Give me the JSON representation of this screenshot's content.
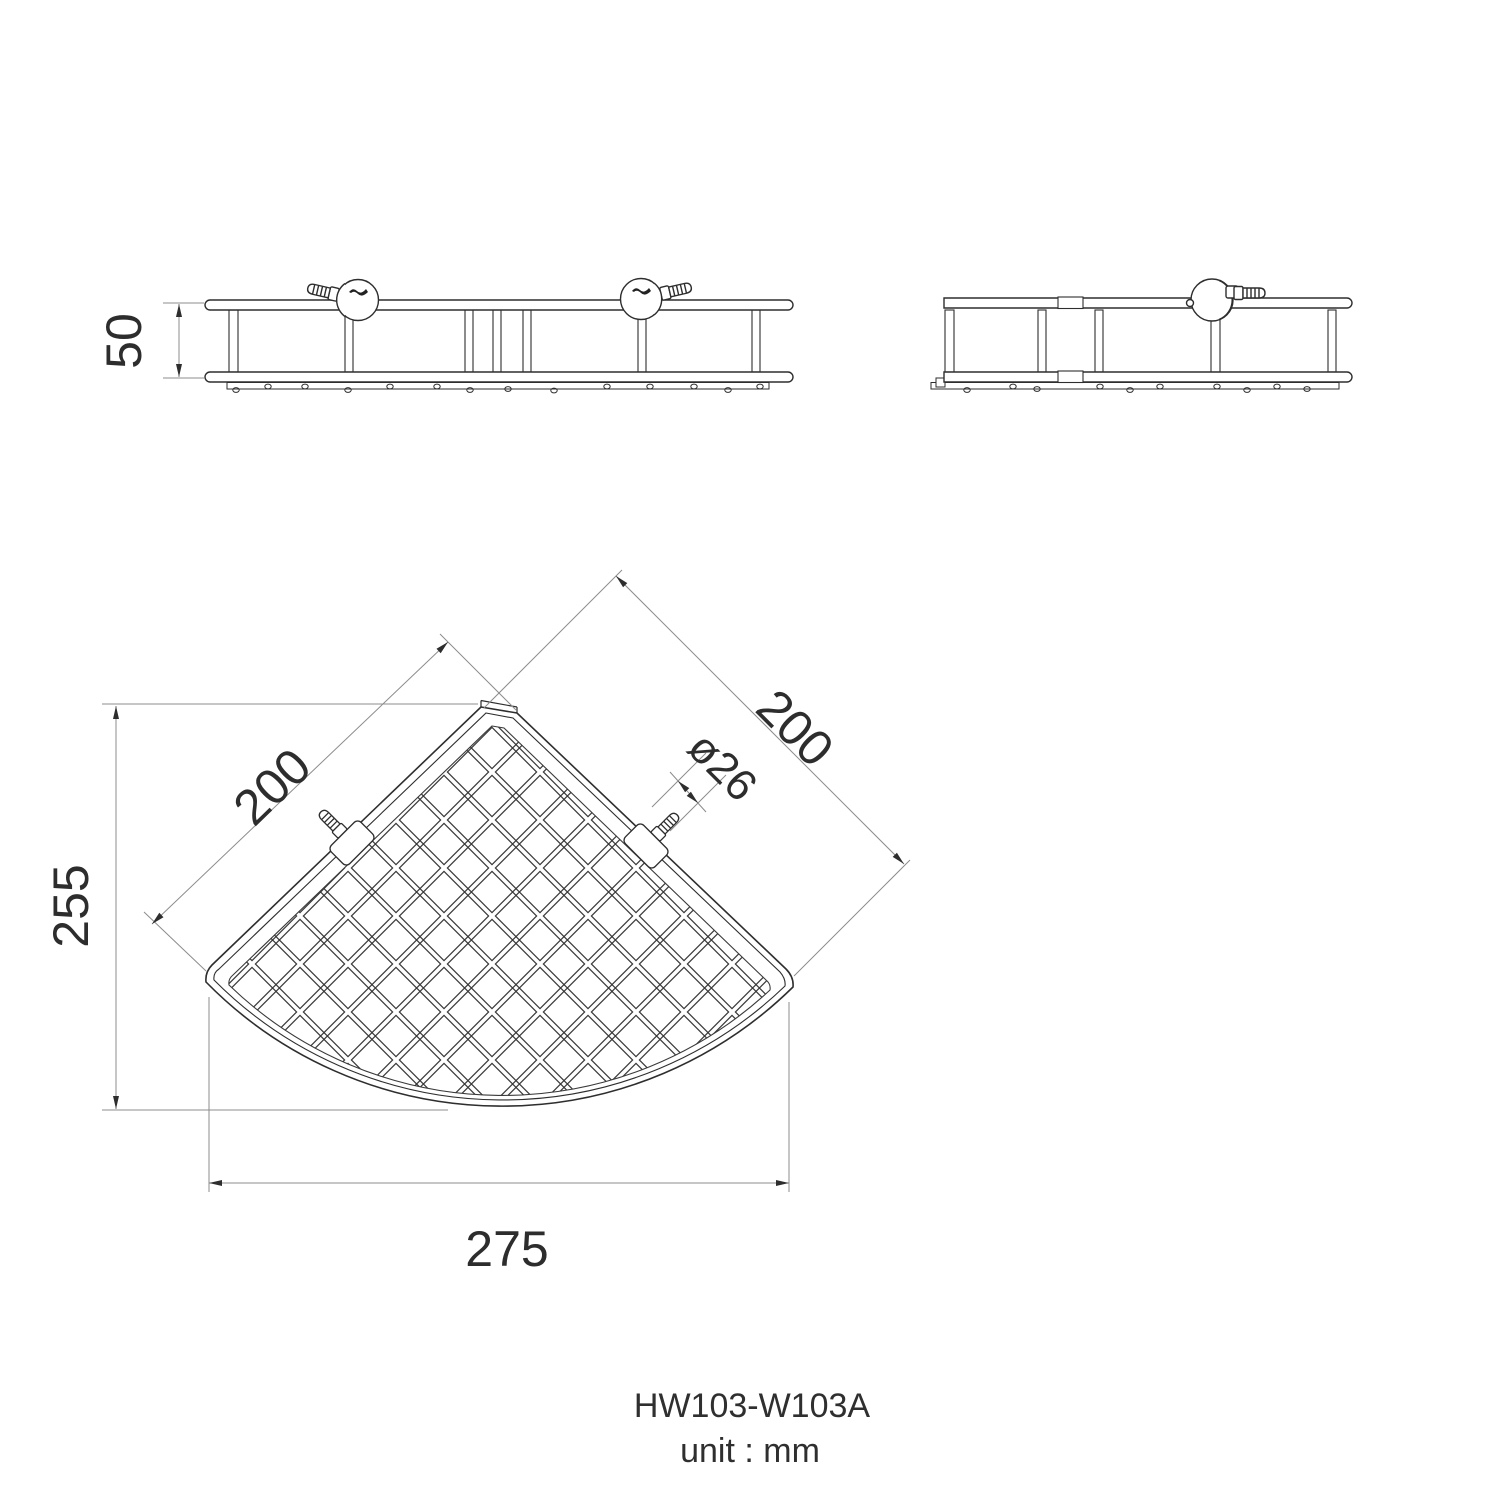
{
  "drawing": {
    "product_code": "HW103-W103A",
    "unit_note": "unit : mm",
    "views": {
      "front": {
        "height_dim": "50"
      },
      "plan": {
        "depth_dim": "255",
        "width_dim": "275",
        "left_side_dim": "200",
        "right_side_dim": "200",
        "bracket_dia_dim": "ø26"
      }
    },
    "colors": {
      "object_line": "#2e2e2e",
      "dimension_line": "#8c8c8c",
      "text": "#2d2d2d",
      "background": "#ffffff"
    }
  }
}
